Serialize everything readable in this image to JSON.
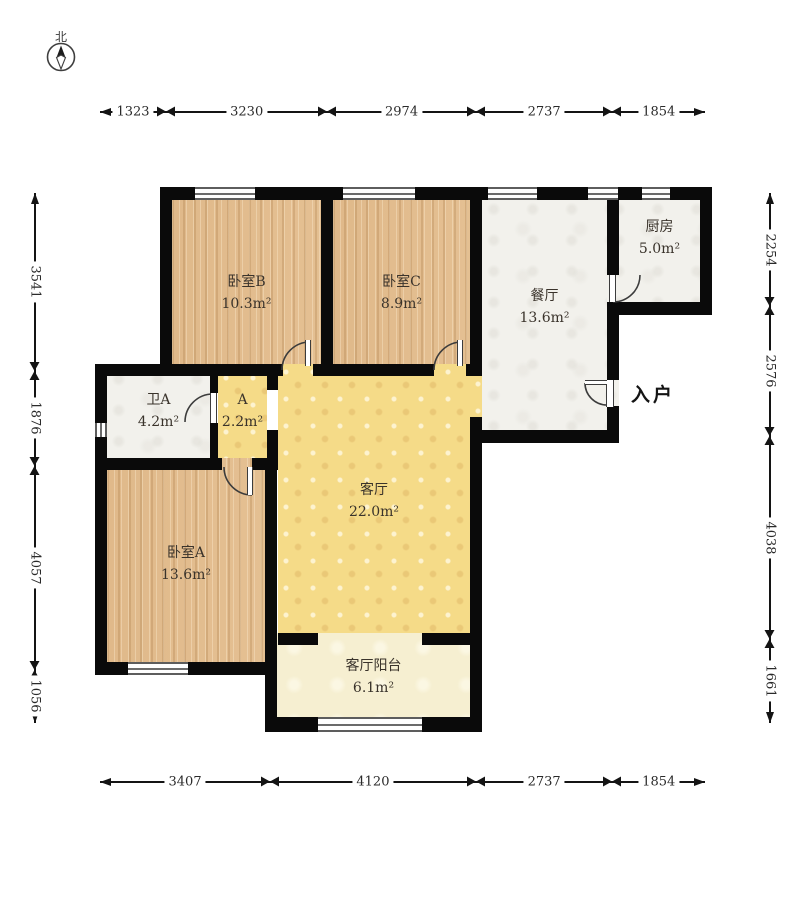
{
  "title": "户型图",
  "compass": {
    "label": "北"
  },
  "entrance": {
    "label": "入户"
  },
  "rooms": [
    {
      "id": "bedroom-b",
      "name": "卧室B",
      "area": "10.3m²",
      "floor": "wood"
    },
    {
      "id": "bedroom-c",
      "name": "卧室C",
      "area": "8.9m²",
      "floor": "wood"
    },
    {
      "id": "dining",
      "name": "餐厅",
      "area": "13.6m²",
      "floor": "tile"
    },
    {
      "id": "kitchen",
      "name": "厨房",
      "area": "5.0m²",
      "floor": "tile"
    },
    {
      "id": "bath-a",
      "name": "卫A",
      "area": "4.2m²",
      "floor": "tile"
    },
    {
      "id": "hall-a",
      "name": "A",
      "area": "2.2m²",
      "floor": "yellow"
    },
    {
      "id": "living",
      "name": "客厅",
      "area": "22.0m²",
      "floor": "yellow"
    },
    {
      "id": "bedroom-a",
      "name": "卧室A",
      "area": "13.6m²",
      "floor": "wood"
    },
    {
      "id": "balcony",
      "name": "客厅阳台",
      "area": "6.1m²",
      "floor": "cream"
    }
  ],
  "dimensions": {
    "top": [
      1323,
      3230,
      2974,
      2737,
      1854
    ],
    "bottom": [
      3407,
      4120,
      2737,
      1854
    ],
    "left": [
      3541,
      1876,
      4057,
      1056
    ],
    "right": [
      2254,
      2576,
      4038,
      1661
    ]
  },
  "colors": {
    "wall": "#0a0a0a",
    "wood_floor": "#e4bf92",
    "living_floor": "#f5db88",
    "tile_floor": "#f2f1ec",
    "balcony_floor": "#f6efd1"
  }
}
